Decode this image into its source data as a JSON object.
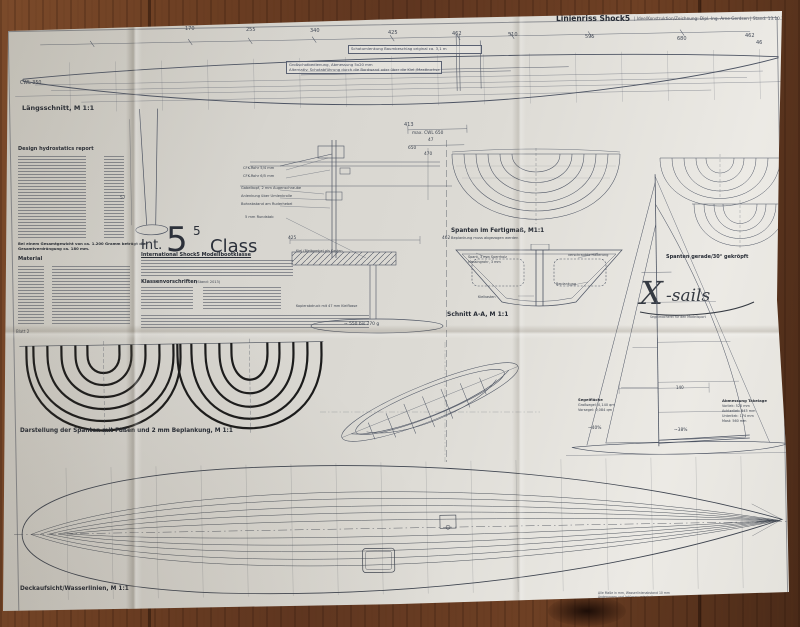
{
  "palette": {
    "wood": "#6b3f23",
    "paper": "#dcdad4",
    "ink": "#4d5463",
    "dark_curves": "#1b1b1b"
  },
  "header": {
    "title": "Linienriss Shock5",
    "meta": "| Idee/Konstruktion/Zeichnung: Dipl.-Ing. Arne Gerdsen | Stand: 13.10.2013"
  },
  "long_section": {
    "label": "Längsschnitt, M 1:1",
    "cwl": "CWL 350",
    "dims_top": [
      "85",
      "170",
      "255",
      "340",
      "425",
      "462",
      "510",
      "595",
      "680"
    ],
    "dim_right_a": "462",
    "dim_right_b": "46",
    "dim_413": "413",
    "dim_cwl": "max. CWL 650",
    "dim_47": "47",
    "dim_650": "650",
    "dim_57": "57",
    "note_boom": "Schotumlenkung Baumbeschlag original ca. 3,1 m",
    "note_sheet_1": "Großschotbedienung, Abmessung 5x20 mm",
    "note_sheet_2": "Alternativ: Schotabführung durch die Bordwand oder über die Kiel-/Mastbuchse"
  },
  "hydro": {
    "heading": "Design hydrostatics report"
  },
  "material": {
    "note1": "Bei einem Gesamtgewicht von ca. 1.200 Gramm beträgt die",
    "note2": "Gesamtverdrängung ca. 180 mm.",
    "heading": "Material"
  },
  "class_block": {
    "prefix": "Int.",
    "big": "5",
    "sup": "5",
    "word": "Class",
    "subtitle": "International Shock5 Modellbootklasse",
    "rules_heading": "Klassenvorschriften",
    "rules_stand": "(Stand: 2013)"
  },
  "mast_detail": {
    "labels": [
      "CFK-Rohr 5/4 mm",
      "CFK-Rohr 6/5 mm",
      "Gabelkopf, 2 mm Augenschraube",
      "Anlenkung über Umlenkrolle",
      "Bohrabstand am Ruderhebel",
      "5 mm Rundstab"
    ],
    "dim_470": "470",
    "dim_425": "425",
    "dim_462": "462",
    "keel_note": "Kiel (Bleibombe) als Kasten",
    "profile_note": "Kopierabdruck mit 47 mm Kielflosse",
    "ballast": "~ 550 bis 770 g"
  },
  "body_plan": {
    "label": "Spanten im Fertigmaß, M1:1",
    "sub": "Beplankung muss abgezogen werden"
  },
  "section_aa": {
    "label": "Schnitt A-A, M 1:1",
    "lbl_spant": "Spant, 3 mm Sperrholz",
    "lbl_rohr": "Messingrohr, 3 mm",
    "lbl_halter": "verschraubte Halterung",
    "lbl_beplankung": "Beplankung",
    "lbl_kielkasten": "Kielkasten"
  },
  "right_plans": {
    "label": "Spanten gerade/30° gekröpft"
  },
  "xsails": {
    "logo_x": "X",
    "logo_rest": "-sails",
    "tagline": "Segelmacherei für den Modellsport"
  },
  "sail_plan": {
    "dim_140": "140",
    "area_heading": "Segelfläche",
    "area_main": "Großsegel: 0,140 qm",
    "area_jib": "Vorsegel: 0,084 qm",
    "rig_heading": "Abmessung Takelage",
    "rig_rows": [
      "Vorliek: 520 mm",
      "Achterliek: 545 mm",
      "Unterliek: 174 mm",
      "Mast: 560 mm"
    ],
    "pct_left": "~40%",
    "pct_right": "~38%"
  },
  "frames_view": {
    "sheet_no": "Blatt 2",
    "label": "Darstellung der Spanten mit Füßen und 2 mm Beplankung, M 1:1"
  },
  "deck_plan": {
    "label": "Deckaufsicht/Wasserlinien, M 1:1",
    "fineprint_1": "Alle Maße in mm, Wasserlinienabstand 10 mm",
    "fineprint_2": "Änderungen und Irrtümer vorbehalten"
  }
}
